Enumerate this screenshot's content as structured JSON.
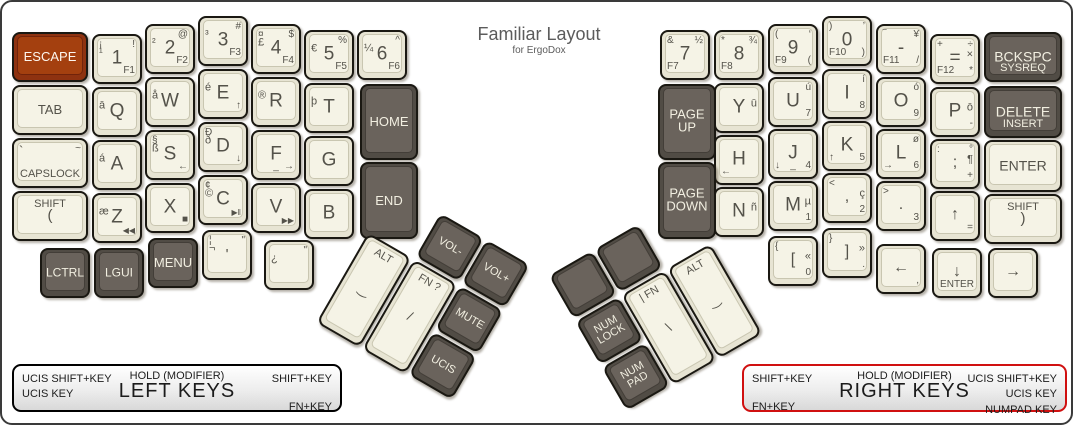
{
  "title": {
    "main": "Familiar Layout",
    "sub": "for ErgoDox"
  },
  "colors": {
    "accent": "#8e3210",
    "key_dark": "#514c45",
    "key_light": "#f5f3e6",
    "legend_red": "#d01010"
  },
  "legend_left": {
    "left_line1": "UCIS SHIFT+KEY",
    "left_line2": "UCIS KEY",
    "center_top": "HOLD (MODIFIER)",
    "center_main": "LEFT KEYS",
    "right_top": "SHIFT+KEY",
    "right_bottom": "FN+KEY"
  },
  "legend_right": {
    "left_top": "SHIFT+KEY",
    "left_bottom": "FN+KEY",
    "center_top": "HOLD (MODIFIER)",
    "center_main": "RIGHT KEYS",
    "right_line1": "UCIS SHIFT+KEY",
    "right_line2": "UCIS KEY",
    "right_line3": "NUMPAD KEY"
  },
  "keys": [
    {
      "id": "escape",
      "x": 10,
      "y": 30,
      "w": 76,
      "t": "accent",
      "l": {
        "c": [
          "ESCAPE",
          13
        ]
      }
    },
    {
      "id": "1",
      "x": 90,
      "y": 32,
      "l": {
        "c": "1",
        "tl": "¡",
        "ml": "¹",
        "tr": "!",
        "br": "F1"
      }
    },
    {
      "id": "2",
      "x": 143,
      "y": 22,
      "l": {
        "c": "2",
        "ml": "²",
        "tr": "@",
        "br": "F2"
      }
    },
    {
      "id": "3",
      "x": 196,
      "y": 14,
      "l": {
        "c": "3",
        "ml": "³",
        "tr": "#",
        "br": "F3"
      }
    },
    {
      "id": "4",
      "x": 249,
      "y": 22,
      "l": {
        "c": "4",
        "tl": "¤",
        "ml": "£",
        "tr": "$",
        "br": "F4"
      }
    },
    {
      "id": "5",
      "x": 302,
      "y": 28,
      "l": {
        "c": "5",
        "ml": "€",
        "tr": "%",
        "br": "F5"
      }
    },
    {
      "id": "6",
      "x": 355,
      "y": 28,
      "l": {
        "c": "6",
        "ml": "¼",
        "tr": "^",
        "br": "F6"
      }
    },
    {
      "id": "tab",
      "x": 10,
      "y": 83,
      "w": 76,
      "l": {
        "c": [
          "TAB",
          13
        ]
      }
    },
    {
      "id": "q",
      "x": 90,
      "y": 85,
      "l": {
        "c": "Q",
        "ml": "ā"
      }
    },
    {
      "id": "w",
      "x": 143,
      "y": 75,
      "l": {
        "c": "W",
        "ml": "å"
      }
    },
    {
      "id": "e",
      "x": 196,
      "y": 67,
      "l": {
        "c": "E",
        "ml": "é",
        "br": "↑"
      }
    },
    {
      "id": "r",
      "x": 249,
      "y": 75,
      "l": {
        "c": "R",
        "ml": "®"
      }
    },
    {
      "id": "t",
      "x": 302,
      "y": 81,
      "l": {
        "c": "T",
        "ml": "þ"
      }
    },
    {
      "id": "home",
      "x": 358,
      "y": 82,
      "w": 58,
      "h": 76,
      "t": "dark",
      "l": {
        "c": [
          "HOME",
          13
        ]
      }
    },
    {
      "id": "capslock",
      "x": 10,
      "y": 136,
      "w": 76,
      "l": {
        "tl": [
          "`",
          13
        ],
        "tr": "~",
        "b": [
          "CAPSLOCK",
          11
        ]
      }
    },
    {
      "id": "a",
      "x": 90,
      "y": 138,
      "l": {
        "c": "A",
        "ml": "á"
      }
    },
    {
      "id": "s",
      "x": 143,
      "y": 128,
      "l": {
        "c": "S",
        "tl": "§",
        "ml": "ß",
        "br": "←"
      }
    },
    {
      "id": "d",
      "x": 196,
      "y": 120,
      "l": {
        "c": "D",
        "tl": "Ð",
        "ml": "ð",
        "br": "↓"
      }
    },
    {
      "id": "f",
      "x": 249,
      "y": 128,
      "l": {
        "c": "F",
        "b": "_",
        "br": "→"
      }
    },
    {
      "id": "g",
      "x": 302,
      "y": 134,
      "l": {
        "c": "G"
      }
    },
    {
      "id": "end",
      "x": 358,
      "y": 160,
      "w": 58,
      "h": 77,
      "t": "dark",
      "l": {
        "c": [
          "END",
          13
        ]
      }
    },
    {
      "id": "lshift",
      "x": 10,
      "y": 189,
      "w": 76,
      "l": {
        "t": [
          "SHIFT",
          11
        ],
        "c": [
          "(",
          15
        ]
      }
    },
    {
      "id": "z",
      "x": 90,
      "y": 191,
      "l": {
        "c": "Z",
        "ml": "æ",
        "br": [
          "◀◀",
          8
        ]
      }
    },
    {
      "id": "x",
      "x": 143,
      "y": 181,
      "l": {
        "c": "X",
        "br": [
          "■",
          10
        ]
      }
    },
    {
      "id": "c",
      "x": 196,
      "y": 173,
      "l": {
        "c": "C",
        "tl": "¢",
        "ml": "©",
        "br": [
          "▶‖",
          8
        ]
      }
    },
    {
      "id": "v",
      "x": 249,
      "y": 181,
      "l": {
        "c": "V",
        "br": [
          "▶▶",
          8
        ]
      }
    },
    {
      "id": "b",
      "x": 302,
      "y": 187,
      "l": {
        "c": "B"
      }
    },
    {
      "id": "lctrl",
      "x": 38,
      "y": 246,
      "t": "dark",
      "l": {
        "c": [
          "LCTRL",
          12
        ]
      }
    },
    {
      "id": "lgui",
      "x": 92,
      "y": 246,
      "t": "dark",
      "l": {
        "c": [
          "LGUI",
          12
        ]
      }
    },
    {
      "id": "menu",
      "x": 146,
      "y": 236,
      "t": "dark",
      "l": {
        "c": [
          "MENU",
          13
        ]
      }
    },
    {
      "id": "quote",
      "x": 200,
      "y": 228,
      "l": {
        "c": [
          "'",
          15
        ],
        "tl": "¦",
        "ml": "¬",
        "tr": "\""
      }
    },
    {
      "id": "inv-question",
      "x": 262,
      "y": 238,
      "l": {
        "ml": "¿",
        "tr": "\""
      }
    },
    {
      "id": "7",
      "x": 658,
      "y": 28,
      "l": {
        "c": "7",
        "tl": "&",
        "tr": "½",
        "bl": "F7"
      }
    },
    {
      "id": "8",
      "x": 712,
      "y": 28,
      "l": {
        "c": "8",
        "tl": "*",
        "tr": "¾",
        "bl": "F8"
      }
    },
    {
      "id": "9",
      "x": 766,
      "y": 22,
      "l": {
        "c": "9",
        "tl": "(",
        "tr": "‘",
        "bl": "F9",
        "br": "("
      }
    },
    {
      "id": "0",
      "x": 820,
      "y": 14,
      "l": {
        "c": "0",
        "tl": ")",
        "tr": "’",
        "bl": "F10",
        "br": ")"
      }
    },
    {
      "id": "minus",
      "x": 874,
      "y": 22,
      "l": {
        "c": "-",
        "tl": "‾",
        "tr": "¥",
        "bl": "F11",
        "br": "/"
      }
    },
    {
      "id": "equals",
      "x": 928,
      "y": 32,
      "l": {
        "c": "=",
        "tl": "+",
        "tr": "÷",
        "mr": "×",
        "bl": "F12",
        "br": "*"
      }
    },
    {
      "id": "bckspc",
      "x": 982,
      "y": 30,
      "w": 78,
      "t": "dark",
      "l": {
        "c": [
          "BCKSPC",
          14
        ],
        "b": [
          "SYSREQ",
          11
        ]
      }
    },
    {
      "id": "pageup",
      "x": 656,
      "y": 82,
      "w": 58,
      "h": 76,
      "t": "dark",
      "l": {
        "c": [
          "PAGE\nUP",
          13
        ]
      }
    },
    {
      "id": "y",
      "x": 712,
      "y": 81,
      "l": {
        "c": "Y",
        "mr": "ū"
      }
    },
    {
      "id": "u",
      "x": 766,
      "y": 75,
      "l": {
        "c": "U",
        "tr": "ú",
        "br": "7"
      }
    },
    {
      "id": "i",
      "x": 820,
      "y": 67,
      "l": {
        "c": "I",
        "tr": "í",
        "br": "8"
      }
    },
    {
      "id": "o",
      "x": 874,
      "y": 75,
      "l": {
        "c": "O",
        "tr": "ó",
        "br": "9"
      }
    },
    {
      "id": "p",
      "x": 928,
      "y": 85,
      "l": {
        "c": "P",
        "mr": "ō",
        "br": "-"
      }
    },
    {
      "id": "delete",
      "x": 982,
      "y": 84,
      "w": 78,
      "h": 52,
      "t": "dark",
      "l": {
        "c": [
          "DELETE",
          14
        ],
        "b": [
          "INSERT",
          11
        ]
      }
    },
    {
      "id": "h",
      "x": 712,
      "y": 133,
      "l": {
        "c": "H",
        "bl": "←"
      }
    },
    {
      "id": "j",
      "x": 766,
      "y": 127,
      "l": {
        "c": "J",
        "bl": "↓",
        "b": "_",
        "br": "4"
      }
    },
    {
      "id": "k",
      "x": 820,
      "y": 119,
      "l": {
        "c": "K",
        "bl": "↑",
        "br": "5"
      }
    },
    {
      "id": "l",
      "x": 874,
      "y": 127,
      "l": {
        "c": "L",
        "tr": "ø",
        "bl": "→",
        "br": "6"
      }
    },
    {
      "id": "semicolon",
      "x": 928,
      "y": 137,
      "l": {
        "c": [
          ";",
          16
        ],
        "tl": ":",
        "tr": "°",
        "mr": "¶",
        "br": "+"
      }
    },
    {
      "id": "enter",
      "x": 982,
      "y": 138,
      "w": 78,
      "h": 52,
      "l": {
        "c": [
          "ENTER",
          14
        ]
      }
    },
    {
      "id": "pagedown",
      "x": 656,
      "y": 160,
      "w": 58,
      "h": 77,
      "t": "dark",
      "l": {
        "c": [
          "PAGE\nDOWN",
          13
        ]
      }
    },
    {
      "id": "n",
      "x": 712,
      "y": 185,
      "l": {
        "c": "N",
        "mr": "ñ"
      }
    },
    {
      "id": "m",
      "x": 766,
      "y": 179,
      "l": {
        "c": "M",
        "mr": "µ",
        "br": "1"
      }
    },
    {
      "id": "comma",
      "x": 820,
      "y": 171,
      "l": {
        "c": [
          ",",
          16
        ],
        "tl": "<",
        "mr": "ç",
        "br": "2"
      }
    },
    {
      "id": "period",
      "x": 874,
      "y": 179,
      "l": {
        "c": [
          ".",
          16
        ],
        "tl": ">",
        "br": "3"
      }
    },
    {
      "id": "up",
      "x": 928,
      "y": 189,
      "l": {
        "c": [
          "↑",
          16
        ],
        "br": "="
      }
    },
    {
      "id": "rshift",
      "x": 982,
      "y": 192,
      "w": 78,
      "l": {
        "t": [
          "SHIFT",
          11
        ],
        "c": [
          ")",
          15
        ]
      }
    },
    {
      "id": "lbracket",
      "x": 766,
      "y": 234,
      "l": {
        "c": [
          "[",
          16
        ],
        "tl": "{",
        "mr": "«",
        "br": "0"
      }
    },
    {
      "id": "rbracket",
      "x": 820,
      "y": 226,
      "l": {
        "c": [
          "]",
          16
        ],
        "tl": "}",
        "mr": "»",
        "br": "."
      }
    },
    {
      "id": "arrow-left",
      "x": 874,
      "y": 242,
      "l": {
        "c": [
          "←",
          16
        ],
        "br": ","
      }
    },
    {
      "id": "arrow-down",
      "x": 930,
      "y": 246,
      "l": {
        "c": [
          "↓",
          16
        ],
        "b": [
          "ENTER",
          10
        ]
      }
    },
    {
      "id": "arrow-right",
      "x": 986,
      "y": 246,
      "l": {
        "c": [
          "→",
          16
        ]
      }
    }
  ],
  "clusters": [
    {
      "id": "left-thumb",
      "x": 342,
      "y": 214,
      "rot": 30,
      "keys": [
        {
          "id": "vol-minus",
          "x": 53,
          "y": 0,
          "t": "dark",
          "l": {
            "c": [
              "VOL-",
              11
            ]
          }
        },
        {
          "id": "vol-plus",
          "x": 106,
          "y": 0,
          "t": "dark",
          "l": {
            "c": [
              "VOL+",
              11
            ]
          }
        },
        {
          "id": "thumb-alt-left",
          "x": 0,
          "y": 53,
          "w": 50,
          "h": 104,
          "l": {
            "t": [
              "ALT",
              11
            ],
            "c": [
              "‿",
              13
            ]
          }
        },
        {
          "id": "thumb-fn-left",
          "x": 53,
          "y": 53,
          "w": 50,
          "h": 104,
          "l": {
            "t": [
              "FN ?",
              11
            ],
            "c": [
              "/",
              13
            ]
          }
        },
        {
          "id": "mute",
          "x": 106,
          "y": 53,
          "t": "dark",
          "l": {
            "c": [
              "MUTE",
              11
            ]
          }
        },
        {
          "id": "ucis",
          "x": 106,
          "y": 106,
          "t": "dark",
          "l": {
            "c": [
              "UCIS",
              11
            ]
          }
        }
      ]
    },
    {
      "id": "right-thumb",
      "x": 576,
      "y": 223,
      "rot": -30,
      "keys": [
        {
          "id": "thumb-blank-1",
          "x": 0,
          "y": 0,
          "t": "dark",
          "l": {}
        },
        {
          "id": "thumb-blank-2",
          "x": 53,
          "y": 0,
          "t": "dark",
          "l": {}
        },
        {
          "id": "numlock",
          "x": 0,
          "y": 53,
          "t": "dark",
          "l": {
            "c": [
              "NUM\nLOCK",
              11
            ]
          }
        },
        {
          "id": "numpad",
          "x": 0,
          "y": 106,
          "t": "dark",
          "l": {
            "c": [
              "NUM\nPAD",
              11
            ]
          }
        },
        {
          "id": "thumb-fn-right",
          "x": 53,
          "y": 53,
          "w": 50,
          "h": 104,
          "l": {
            "t": [
              "| FN",
              11
            ],
            "c": [
              "\\",
              13
            ]
          }
        },
        {
          "id": "thumb-alt-right",
          "x": 106,
          "y": 53,
          "w": 50,
          "h": 104,
          "l": {
            "t": [
              "ALT",
              11
            ],
            "c": [
              "‿",
              13
            ]
          }
        }
      ]
    }
  ]
}
